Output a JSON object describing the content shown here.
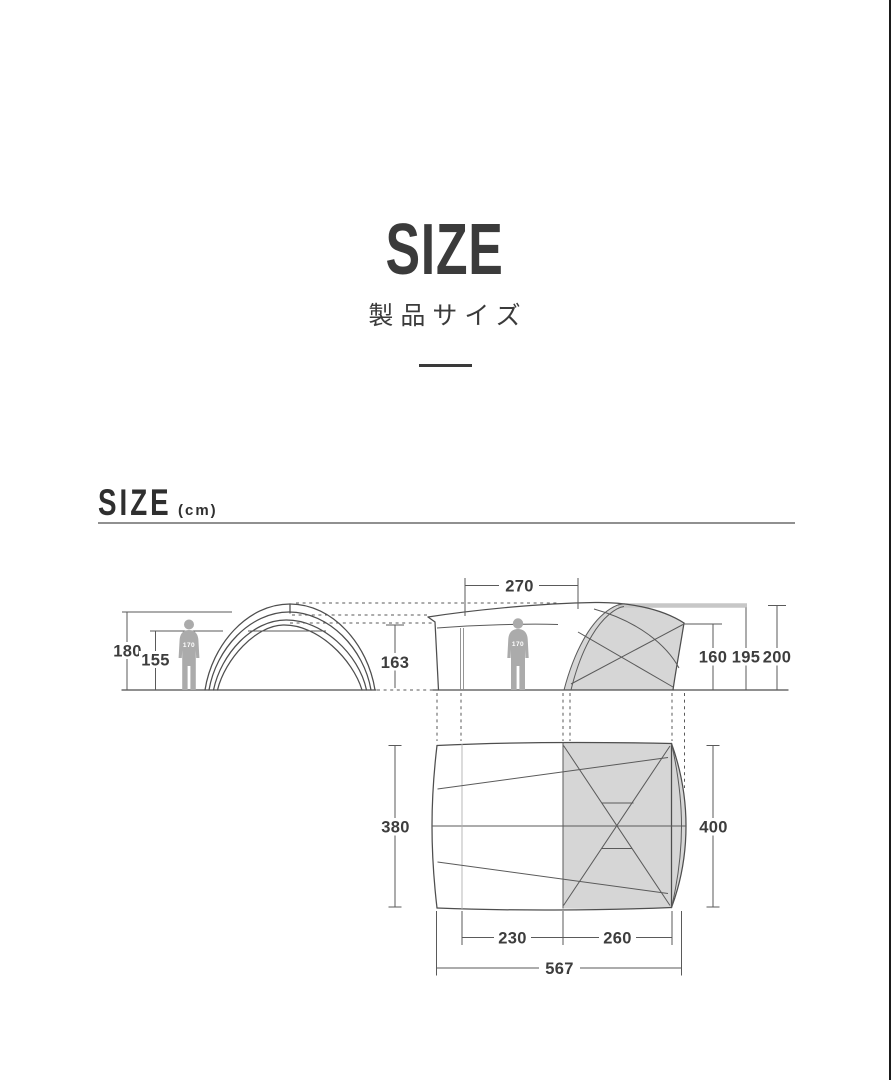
{
  "header": {
    "title": "SIZE",
    "subtitle": "製品サイズ"
  },
  "section": {
    "heading": "SIZE",
    "unit": "(cm)"
  },
  "front_view": {
    "height_outer": "180",
    "height_inner": "155",
    "person": "170"
  },
  "side_view": {
    "top_width": "270",
    "left_height": "163",
    "person": "170",
    "height_inner_peak": "160",
    "height_edge": "195",
    "height_max": "200"
  },
  "top_view": {
    "width_floor": "380",
    "width_outer": "400",
    "length_front": "230",
    "length_inner": "260",
    "length_total": "567"
  },
  "colors": {
    "text": "#3b3b3b",
    "line": "#4e4e4e",
    "shade": "#d6d6d6",
    "person": "#ababab",
    "roof_bar": "#c7c7c7",
    "rule": "#8f8f8f",
    "border": "#1b1b1b"
  }
}
